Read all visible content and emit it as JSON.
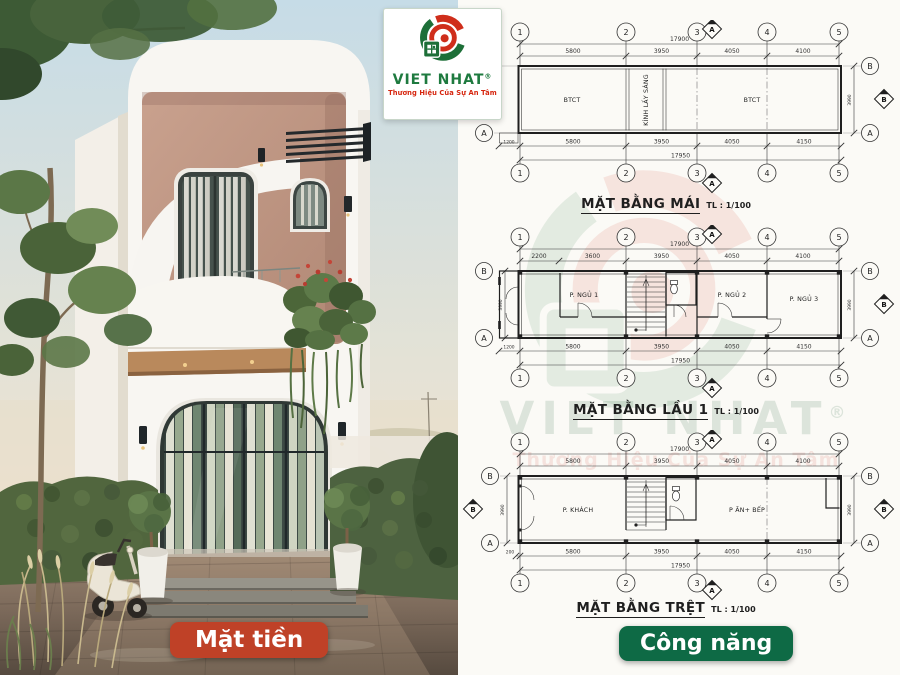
{
  "brand": {
    "logo_name": "VIET NHAT",
    "logo_reg": "®",
    "logo_tagline": "Thương Hiệu Của Sự An Tâm"
  },
  "badges": {
    "facade": "Mặt tiền",
    "function": "Công năng"
  },
  "watermark": {
    "name": "VIET NHAT",
    "reg": "®",
    "tagline": "Thương Hiệu Của Sự An Tâm"
  },
  "colors": {
    "badge_red": "#bf4127",
    "badge_green": "#0e6a45",
    "logo_green": "#1e7a3f",
    "logo_red": "#d6250e"
  },
  "plans": [
    {
      "title": "MẶT BẰNG MÁI",
      "scale": "TL : 1/100",
      "cols": [
        "1",
        "2",
        "3",
        "4",
        "5"
      ],
      "row_top": "B",
      "row_bottom": "A",
      "section_top": "A",
      "section_bottom": "A",
      "section_right": "B",
      "top_total": "17900",
      "top_dims": [
        "5800",
        "3950",
        "4050",
        "4100"
      ],
      "bottom_offset": "1200",
      "bottom_dims": [
        "5800",
        "3950",
        "4050",
        "4150"
      ],
      "bottom_total": "17950",
      "right_dim": "3990",
      "rooms": [
        "BTCT",
        "KÍNH LẤY SÁNG",
        "BTCT"
      ]
    },
    {
      "title": "MẶT BẰNG LẦU 1",
      "scale": "TL : 1/100",
      "cols": [
        "1",
        "2",
        "3",
        "4",
        "5"
      ],
      "row_top": "B",
      "row_bottom": "A",
      "section_top": "A",
      "section_bottom": "A",
      "section_right": "B",
      "top_total": "17900",
      "top_dims": [
        "2200",
        "3600",
        "3950",
        "4050",
        "4100"
      ],
      "bottom_offset": "1200",
      "bottom_dims": [
        "5800",
        "3950",
        "4050",
        "4150"
      ],
      "bottom_total": "17950",
      "right_dim": "3990",
      "left_dim": "3990",
      "rooms": [
        "P. NGỦ 1",
        "P. NGỦ 2",
        "P. NGỦ 3"
      ]
    },
    {
      "title": "MẶT BẰNG TRỆT",
      "scale": "TL : 1/100",
      "cols": [
        "1",
        "2",
        "3",
        "4",
        "5"
      ],
      "row_top": "B",
      "row_bottom": "A",
      "section_top": "A",
      "section_bottom": "A",
      "section_right": "B",
      "section_left": "B",
      "top_total": "17900",
      "top_dims": [
        "5800",
        "3950",
        "4050",
        "4100"
      ],
      "bottom_offset": "200",
      "bottom_dims": [
        "5800",
        "3950",
        "4050",
        "4150"
      ],
      "bottom_total": "17950",
      "right_dim": "3990",
      "left_dim": "3990",
      "rooms": [
        "P. KHÁCH",
        "P ĂN+ BẾP"
      ]
    }
  ]
}
